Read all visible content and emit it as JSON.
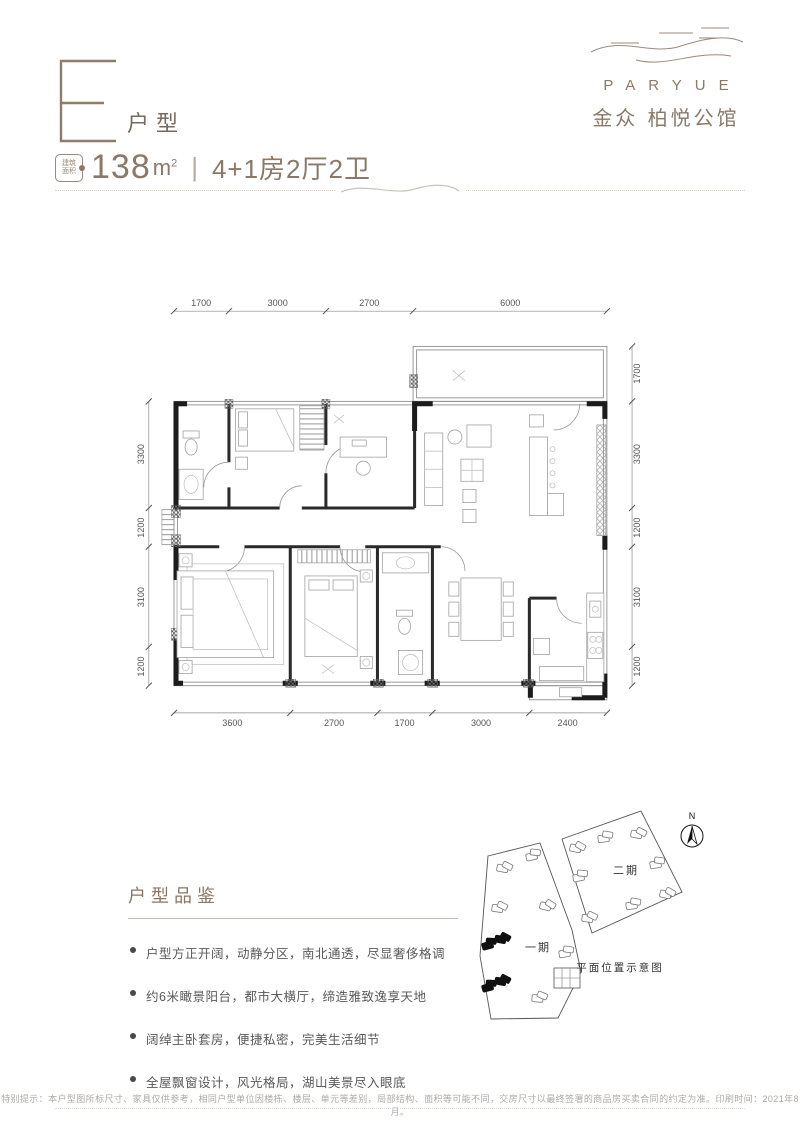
{
  "theme": {
    "accent_color": "#8b7968",
    "wall_color": "#1c1c1c",
    "text_gray": "#595959"
  },
  "header": {
    "unit_letter": "E",
    "unit_type_label": "户型",
    "area_badge_line1": "建筑",
    "area_badge_line2": "面积",
    "area_value": "138",
    "area_unit": "m",
    "area_unit_sup": "2",
    "separator": "|",
    "layout_text": "4+1房2厅2卫"
  },
  "logo": {
    "brand_name": "PARYUE",
    "brand_name_cn": "金众 柏悦公馆"
  },
  "floor_plan": {
    "dims": {
      "top": [
        "1700",
        "3000",
        "2700",
        "6000"
      ],
      "bottom": [
        "3600",
        "2700",
        "1700",
        "3000",
        "2400"
      ],
      "left": [
        "3300",
        "1200",
        "3100",
        "1200"
      ],
      "right": [
        "1700",
        "3300",
        "1200",
        "3100",
        "1200"
      ]
    }
  },
  "features": {
    "title": "户型品鉴",
    "bullets": [
      "户型方正开阔，动静分区，南北通透，尽显奢侈格调",
      "约6米瞰景阳台，都市大横厅，缔造雅致逸享天地",
      "阔绰主卧套房，便捷私密，完美生活细节",
      "全屋飘窗设计，风光格局，湖山美景尽入眼底"
    ]
  },
  "site_plan": {
    "phase1_label": "一期",
    "phase2_label": "二期",
    "compass_label": "N",
    "caption": "平面位置示意图"
  },
  "footer": {
    "disclaimer": "特别提示：本户型图所标尺寸、家具仅供参考，相同户型单位因楼栋、楼层、单元等差别，局部结构、面积等可能不同，交房尺寸以最终签署的商品房买卖合同的约定为准。印刷时间：2021年8月。"
  }
}
